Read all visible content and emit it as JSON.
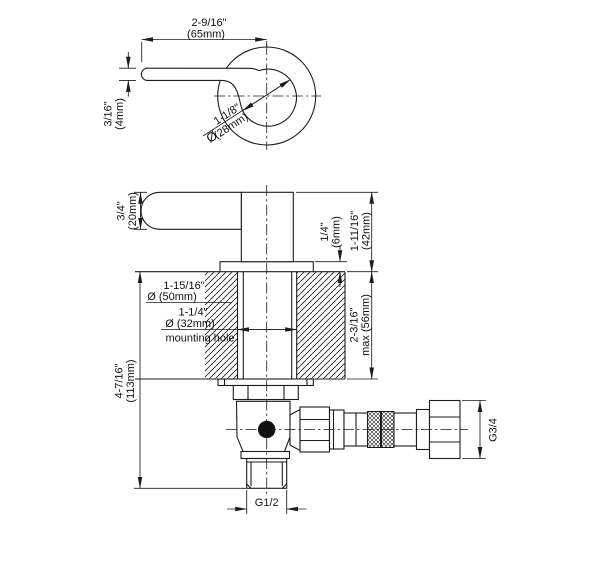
{
  "drawing": {
    "line_color": "#1c1c1c",
    "background": "#ffffff",
    "dims": {
      "lever_length_in": "2-9/16\"",
      "lever_length_mm": "(65mm)",
      "lever_tip_in": "3/16\"",
      "lever_tip_mm": "(4mm)",
      "handle_dia_sym": "Ø",
      "handle_dia_in": "1-1/8\"",
      "handle_dia_mm": "(28mm)",
      "lever_height_in": "3/4\"",
      "lever_height_mm": "(20mm)",
      "flange_height_in": "1/4\"",
      "flange_height_mm": "(6mm)",
      "above_deck_in": "1-11/16\"",
      "above_deck_mm": "(42mm)",
      "escutcheon_dia_in": "1-15/16\"",
      "escutcheon_dia_mm": "Ø (50mm)",
      "mounting_hole_in": "1-1/4\"",
      "mounting_hole_mm": "Ø (32mm)",
      "mounting_hole_label": "mounting hole",
      "deck_thickness_in": "2-3/16\"",
      "deck_thickness_mm": "max (56mm)",
      "total_height_in": "4-7/16\"",
      "total_height_mm": "(113mm)",
      "outlet_thread": "G1/2",
      "inlet_thread": "G3/4"
    }
  }
}
